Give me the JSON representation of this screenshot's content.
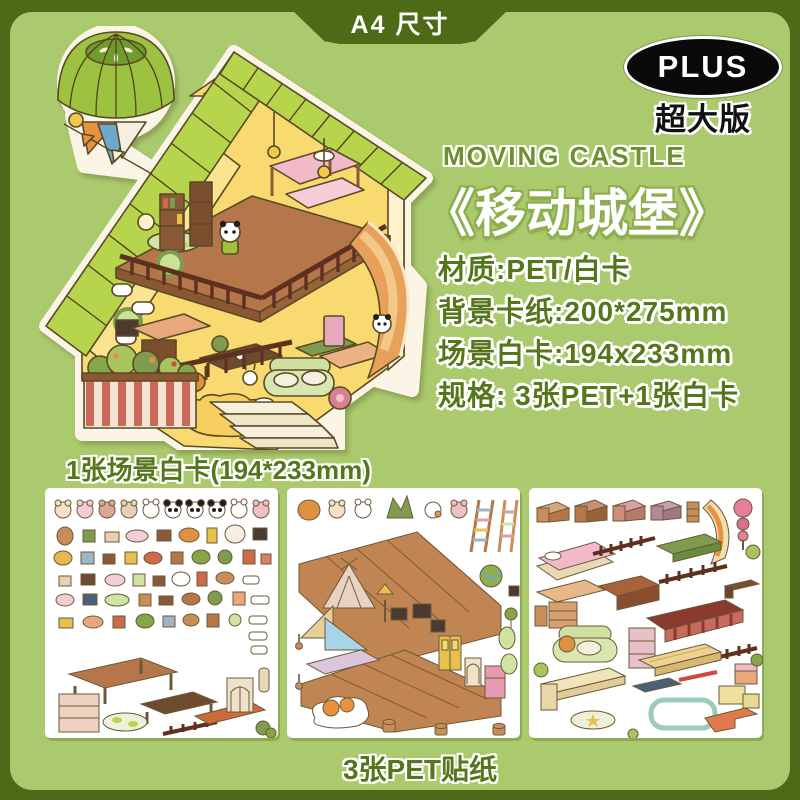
{
  "banner": {
    "label": "A4 尺寸"
  },
  "badge": {
    "plus": "PLUS",
    "subtitle": "超大版"
  },
  "product": {
    "title_en": "MOVING CASTLE",
    "title_zh": "《移动城堡》"
  },
  "specs": {
    "items": [
      "材质:PET/白卡",
      "背景卡纸:200*275mm",
      "场景白卡:194x233mm",
      "规格: 3张PET+1张白卡"
    ]
  },
  "captions": {
    "scene_card": "1张场景白卡(194*233mm)",
    "pet_stickers": "3张PET贴纸"
  },
  "colors": {
    "outer_border_green": "#4d6b17",
    "panel_green": "#abc96d",
    "text_green": "#55761b",
    "title_outline_green": "#8fae4f",
    "badge_black": "#0a0a0a",
    "white": "#ffffff"
  }
}
